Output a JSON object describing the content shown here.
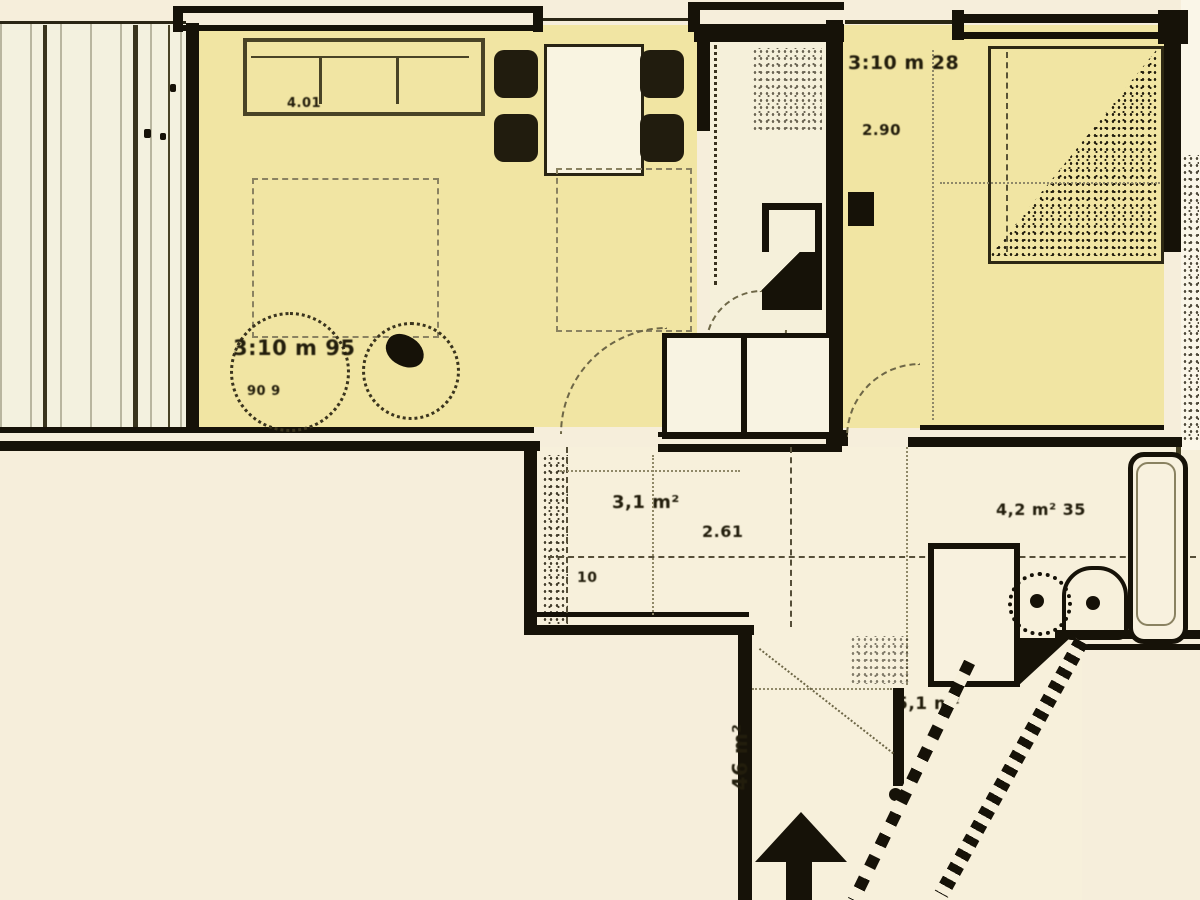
{
  "colors": {
    "paper": "#f6eedb",
    "room_highlight": "#efe3a2",
    "balcony_fill": "#f1efdd",
    "wall": "#18140a",
    "line_olive": "#57503a"
  },
  "labels": {
    "living_dim": "3:10 m 95",
    "living_sub": "90 9",
    "sofa_dim": "4.01",
    "bedroom_dim": "3:10 m 28",
    "bedroom_sub": "2.90",
    "corridor_area": "3,1 m²",
    "corridor_dim": "2.61",
    "step_dim": "10",
    "bath_area": "4,2 m² 35",
    "entrance_area": "5,1 m²",
    "terrace_area": "46 m²"
  }
}
